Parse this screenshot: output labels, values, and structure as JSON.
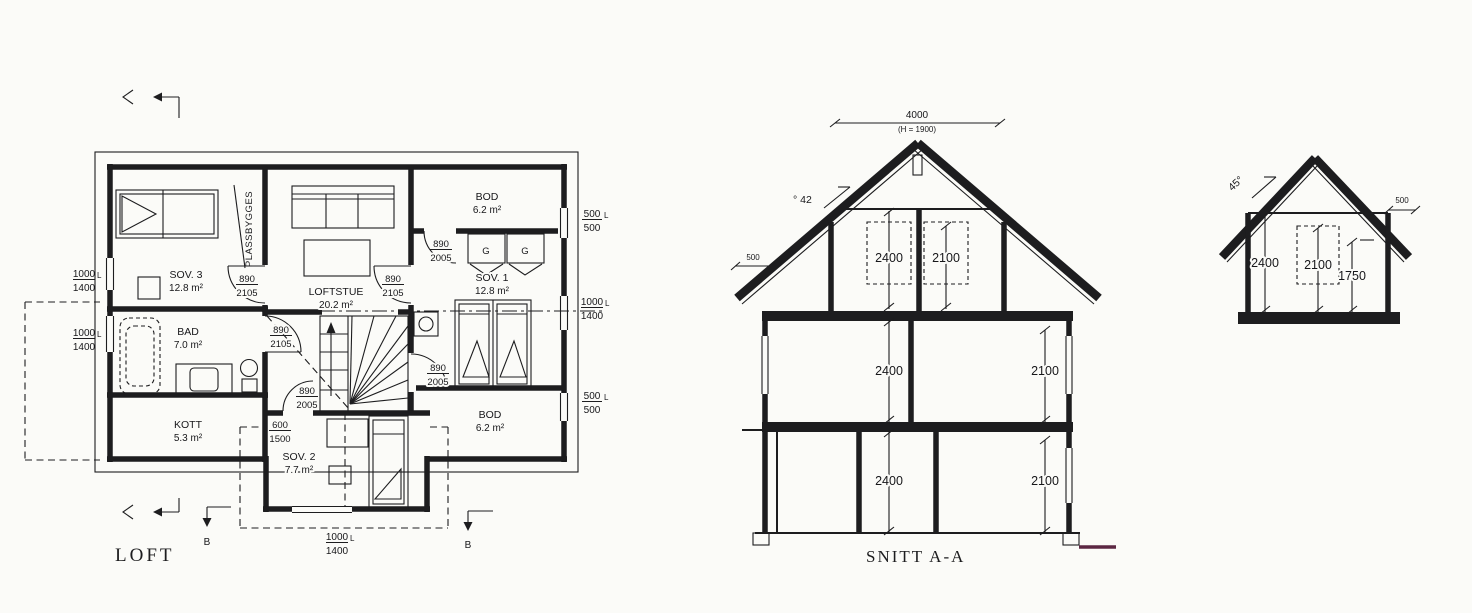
{
  "colors": {
    "paper": "#fbfbf8",
    "ink": "#1d1d1f",
    "ground_line": "#5c2743"
  },
  "floor_plan": {
    "title": "LOFT",
    "section_markers": {
      "left": "B",
      "right": "B"
    },
    "rooms": {
      "sov3": {
        "name": "SOV. 3",
        "area": "12.8 m²"
      },
      "loftstue": {
        "name": "LOFTSTUE",
        "area": "20.2 m²"
      },
      "bod_top": {
        "name": "BOD",
        "area": "6.2 m²"
      },
      "sov1": {
        "name": "SOV. 1",
        "area": "12.8 m²"
      },
      "bad": {
        "name": "BAD",
        "area": "7.0 m²"
      },
      "kott": {
        "name": "KOTT",
        "area": "5.3 m²"
      },
      "sov2": {
        "name": "SOV. 2",
        "area": "7.7 m²"
      },
      "bod_bottom": {
        "name": "BOD",
        "area": "6.2 m²"
      }
    },
    "notes": {
      "plassbygges": "PLASSBYGGES",
      "wardrobe_left": "G",
      "wardrobe_right": "G"
    },
    "doors": {
      "sov3": {
        "width": "890",
        "height": "2105"
      },
      "loftstue": {
        "width": "890",
        "height": "2105"
      },
      "bad": {
        "width": "890",
        "height": "2105"
      },
      "bod_top": {
        "width": "890",
        "height": "2005"
      },
      "hall": {
        "width": "890",
        "height": "2005"
      },
      "sov1": {
        "width": "890",
        "height": "2005"
      },
      "kott": {
        "width": "600",
        "height": "1500"
      }
    },
    "dims": {
      "left_upper": {
        "top": "1000",
        "unit": "L",
        "bottom": "1400"
      },
      "left_lower": {
        "top": "1000",
        "unit": "L",
        "bottom": "1400"
      },
      "right_upper": {
        "top": "500",
        "unit": "L",
        "bottom": "500"
      },
      "right_middle": {
        "top": "1000",
        "unit": "L",
        "bottom": "1400"
      },
      "right_lower": {
        "top": "500",
        "unit": "L",
        "bottom": "500"
      },
      "bottom": {
        "top": "1000",
        "unit": "L",
        "bottom": "1400"
      }
    }
  },
  "section_aa": {
    "title": "SNITT A-A",
    "width_dim": "4000",
    "width_note": "(H = 1900)",
    "roof_pitch": "° 42",
    "eave_dim": "500",
    "loft": {
      "left": "2400",
      "right": "2100"
    },
    "second_floor": {
      "left": "2400",
      "right": "2100"
    },
    "first_floor": {
      "left": "2400",
      "right": "2100"
    }
  },
  "gable_section": {
    "roof_pitch": "45°",
    "eave_dim": "500",
    "heights": {
      "wall": "2400",
      "clear": "2100",
      "knee": "1750"
    }
  }
}
